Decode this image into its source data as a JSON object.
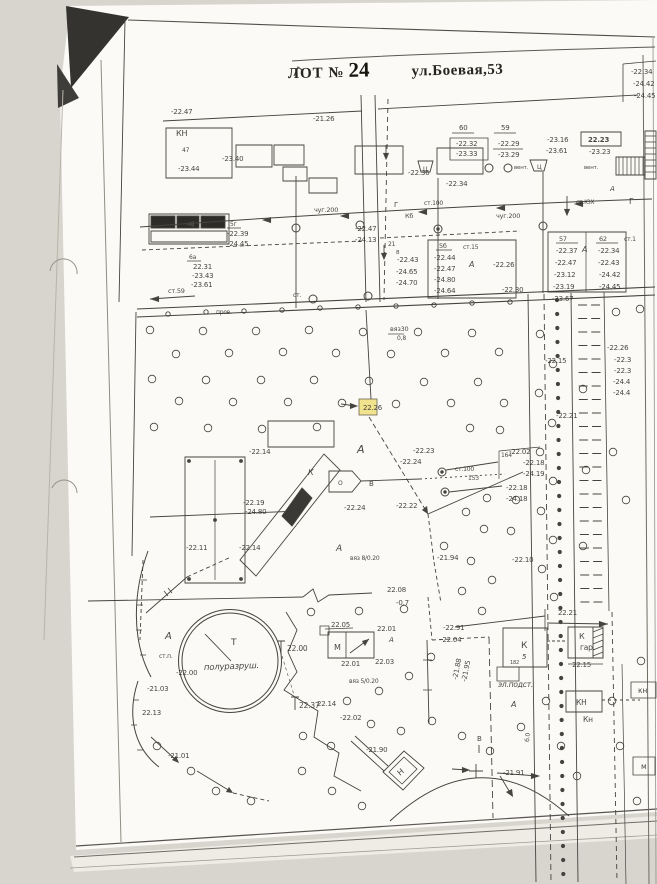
{
  "document": {
    "title_prefix": "ЛОТ №",
    "lot_number": "24",
    "address": "ул.Боевая,53"
  },
  "map": {
    "highlight": {
      "color": "#f1e28e",
      "label": "22.26"
    },
    "annotations": [
      {
        "t": "-22.47",
        "x": 171,
        "y": 114
      },
      {
        "t": "-21.26",
        "x": 313,
        "y": 121
      },
      {
        "t": "КН",
        "x": 176,
        "y": 136,
        "s": 8
      },
      {
        "t": "47",
        "x": 182,
        "y": 152,
        "s": 6
      },
      {
        "t": "-23.44",
        "x": 178,
        "y": 171
      },
      {
        "t": "-23.40",
        "x": 222,
        "y": 161
      },
      {
        "t": "60",
        "x": 459,
        "y": 130
      },
      {
        "t": "59",
        "x": 501,
        "y": 130
      },
      {
        "t": "-22.32",
        "x": 456,
        "y": 146
      },
      {
        "t": "-23.33",
        "x": 456,
        "y": 156
      },
      {
        "t": "-22.29",
        "x": 498,
        "y": 146
      },
      {
        "t": "-23.29",
        "x": 498,
        "y": 157
      },
      {
        "t": "-23.16",
        "x": 547,
        "y": 142
      },
      {
        "t": "-23.61",
        "x": 546,
        "y": 153
      },
      {
        "t": "22.23",
        "x": 588,
        "y": 142,
        "b": 1
      },
      {
        "t": "-23.23",
        "x": 589,
        "y": 154
      },
      {
        "t": "-22.34",
        "x": 631,
        "y": 74
      },
      {
        "t": "-24.42",
        "x": 633,
        "y": 86
      },
      {
        "t": "-24.45",
        "x": 634,
        "y": 98
      },
      {
        "t": "Ц",
        "x": 423,
        "y": 171,
        "s": 6
      },
      {
        "t": "вент.",
        "x": 514,
        "y": 169,
        "s": 5.5
      },
      {
        "t": "Ц",
        "x": 537,
        "y": 169,
        "s": 6
      },
      {
        "t": "вент.",
        "x": 584,
        "y": 169,
        "s": 5.5
      },
      {
        "t": "-22.36",
        "x": 408,
        "y": 175
      },
      {
        "t": "-22.34",
        "x": 446,
        "y": 186
      },
      {
        "t": "чуг.200",
        "x": 314,
        "y": 212,
        "s": 6.5
      },
      {
        "t": "чуг.200",
        "x": 496,
        "y": 218,
        "s": 6.5
      },
      {
        "t": "Кб",
        "x": 405,
        "y": 218,
        "s": 6.5
      },
      {
        "t": "Г",
        "x": 394,
        "y": 207
      },
      {
        "t": "ст.100",
        "x": 424,
        "y": 205,
        "s": 6
      },
      {
        "t": "ст.ЮХ",
        "x": 576,
        "y": 204,
        "s": 6
      },
      {
        "t": "Г",
        "x": 629,
        "y": 204,
        "s": 8
      },
      {
        "t": "А",
        "x": 610,
        "y": 191,
        "i": 1
      },
      {
        "t": "6а",
        "x": 189,
        "y": 259,
        "s": 6
      },
      {
        "t": "22.31",
        "x": 193,
        "y": 269
      },
      {
        "t": "-23.43",
        "x": 192,
        "y": 278
      },
      {
        "t": "-23.61",
        "x": 191,
        "y": 287
      },
      {
        "t": "5г",
        "x": 230,
        "y": 226,
        "s": 6
      },
      {
        "t": "-22.39",
        "x": 227,
        "y": 236
      },
      {
        "t": "-24.45",
        "x": 227,
        "y": 246
      },
      {
        "t": "-22.47",
        "x": 355,
        "y": 231
      },
      {
        "t": "-24.13",
        "x": 355,
        "y": 242
      },
      {
        "t": "21",
        "x": 388,
        "y": 246,
        "s": 6
      },
      {
        "t": "8",
        "x": 396,
        "y": 254,
        "s": 5.5
      },
      {
        "t": "-22.43",
        "x": 397,
        "y": 262
      },
      {
        "t": "-24.65",
        "x": 396,
        "y": 274
      },
      {
        "t": "-24.70",
        "x": 396,
        "y": 285
      },
      {
        "t": "5б",
        "x": 439,
        "y": 248,
        "s": 6.5
      },
      {
        "t": "ст.15",
        "x": 463,
        "y": 249,
        "s": 6
      },
      {
        "t": "-22.44",
        "x": 434,
        "y": 260
      },
      {
        "t": "-22.47",
        "x": 434,
        "y": 271
      },
      {
        "t": "-24.80",
        "x": 434,
        "y": 282
      },
      {
        "t": "-24.64",
        "x": 434,
        "y": 293
      },
      {
        "t": "А",
        "x": 469,
        "y": 267,
        "i": 1,
        "s": 8
      },
      {
        "t": "-22.26",
        "x": 493,
        "y": 267
      },
      {
        "t": "-22.30",
        "x": 502,
        "y": 292
      },
      {
        "t": "57",
        "x": 559,
        "y": 241,
        "s": 6.5
      },
      {
        "t": "-22.37",
        "x": 556,
        "y": 253
      },
      {
        "t": "-22.47",
        "x": 555,
        "y": 265
      },
      {
        "t": "-23.12",
        "x": 554,
        "y": 277
      },
      {
        "t": "-23.19",
        "x": 553,
        "y": 289
      },
      {
        "t": "-23.67",
        "x": 552,
        "y": 301
      },
      {
        "t": "А",
        "x": 582,
        "y": 252,
        "i": 1,
        "s": 8
      },
      {
        "t": "62",
        "x": 599,
        "y": 241,
        "s": 6.5
      },
      {
        "t": "ст.1",
        "x": 624,
        "y": 241,
        "s": 6
      },
      {
        "t": "-22.34",
        "x": 598,
        "y": 253
      },
      {
        "t": "-22.43",
        "x": 598,
        "y": 265
      },
      {
        "t": "-24.42",
        "x": 599,
        "y": 277
      },
      {
        "t": "-24.45",
        "x": 599,
        "y": 289
      },
      {
        "t": "ст.59",
        "x": 168,
        "y": 293,
        "s": 6.5
      },
      {
        "t": "пров.",
        "x": 216,
        "y": 314,
        "s": 6
      },
      {
        "t": "ст.",
        "x": 293,
        "y": 297,
        "s": 6
      },
      {
        "t": "вяз30",
        "x": 390,
        "y": 331,
        "s": 6.5
      },
      {
        "t": "0,8",
        "x": 397,
        "y": 340,
        "s": 6
      },
      {
        "t": "-22.15",
        "x": 545,
        "y": 363
      },
      {
        "t": "-22.26",
        "x": 607,
        "y": 350
      },
      {
        "t": "-22.3",
        "x": 614,
        "y": 362
      },
      {
        "t": "-22.3",
        "x": 614,
        "y": 373
      },
      {
        "t": "-24.4",
        "x": 613,
        "y": 384
      },
      {
        "t": "-24.4",
        "x": 613,
        "y": 395
      },
      {
        "t": "-22.21",
        "x": 556,
        "y": 418
      },
      {
        "t": "22.26",
        "x": 363,
        "y": 410,
        "n": "highlighted-elevation-label"
      },
      {
        "t": "А",
        "x": 357,
        "y": 453,
        "i": 1,
        "s": 11
      },
      {
        "t": "-22.23",
        "x": 413,
        "y": 453
      },
      {
        "t": "-22.24",
        "x": 400,
        "y": 464
      },
      {
        "t": "ст.100",
        "x": 455,
        "y": 471,
        "s": 6
      },
      {
        "t": "153",
        "x": 468,
        "y": 480,
        "s": 6
      },
      {
        "t": "164",
        "x": 501,
        "y": 457,
        "s": 6
      },
      {
        "t": "-22.18",
        "x": 523,
        "y": 465
      },
      {
        "t": "-24.19",
        "x": 523,
        "y": 476
      },
      {
        "t": "-22.18",
        "x": 506,
        "y": 490
      },
      {
        "t": "-24.18",
        "x": 506,
        "y": 501
      },
      {
        "t": "В",
        "x": 369,
        "y": 486
      },
      {
        "t": "О",
        "x": 338,
        "y": 485,
        "s": 6
      },
      {
        "t": "-22.22",
        "x": 396,
        "y": 508
      },
      {
        "t": "-22.02",
        "x": 509,
        "y": 454
      },
      {
        "t": "К",
        "x": 308,
        "y": 475,
        "i": 1,
        "s": 8
      },
      {
        "t": "-22.14",
        "x": 249,
        "y": 454
      },
      {
        "t": "-22.19",
        "x": 243,
        "y": 505
      },
      {
        "t": "-24.80",
        "x": 245,
        "y": 514
      },
      {
        "t": "-22.24",
        "x": 344,
        "y": 510
      },
      {
        "t": "-22.11",
        "x": 186,
        "y": 550
      },
      {
        "t": "-22.14",
        "x": 239,
        "y": 550
      },
      {
        "t": "А",
        "x": 336,
        "y": 551,
        "i": 1,
        "s": 9
      },
      {
        "t": "вяз 8/0.20",
        "x": 350,
        "y": 560,
        "s": 6
      },
      {
        "t": "-21.94",
        "x": 437,
        "y": 560
      },
      {
        "t": "-22.10",
        "x": 512,
        "y": 562
      },
      {
        "t": "22.08",
        "x": 387,
        "y": 592
      },
      {
        "t": "-0.7",
        "x": 396,
        "y": 605
      },
      {
        "t": "22.05",
        "x": 331,
        "y": 627
      },
      {
        "t": "22.01",
        "x": 377,
        "y": 631
      },
      {
        "t": "А",
        "x": 389,
        "y": 642,
        "i": 1,
        "s": 7
      },
      {
        "t": "-22.91",
        "x": 443,
        "y": 630
      },
      {
        "t": "-22.04",
        "x": 440,
        "y": 642
      },
      {
        "t": "М",
        "x": 334,
        "y": 650,
        "s": 8
      },
      {
        "t": "22.01",
        "x": 341,
        "y": 666
      },
      {
        "t": "22.03",
        "x": 375,
        "y": 664
      },
      {
        "t": "-21.88",
        "x": 457,
        "y": 680,
        "r": -78
      },
      {
        "t": "-21.95",
        "x": 466,
        "y": 682,
        "r": -78
      },
      {
        "t": "вяз 5/0.20",
        "x": 349,
        "y": 683,
        "s": 6
      },
      {
        "t": "22.14",
        "x": 317,
        "y": 706
      },
      {
        "t": "-22.02",
        "x": 340,
        "y": 720
      },
      {
        "t": "-21.90",
        "x": 366,
        "y": 752
      },
      {
        "t": "-21.91",
        "x": 503,
        "y": 775
      },
      {
        "t": "В",
        "x": 477,
        "y": 741
      },
      {
        "t": "Н",
        "x": 400,
        "y": 776,
        "s": 8,
        "r": -40
      },
      {
        "t": "22.21",
        "x": 558,
        "y": 615
      },
      {
        "t": "К",
        "x": 521,
        "y": 648,
        "s": 9
      },
      {
        "t": "5",
        "x": 522,
        "y": 659,
        "i": 1,
        "s": 7
      },
      {
        "t": "182",
        "x": 510,
        "y": 664,
        "s": 5
      },
      {
        "t": "эл.подст.",
        "x": 498,
        "y": 687,
        "i": 1,
        "s": 7.5
      },
      {
        "t": "А",
        "x": 511,
        "y": 707,
        "i": 1,
        "s": 8
      },
      {
        "t": "К",
        "x": 579,
        "y": 639,
        "s": 8
      },
      {
        "t": "гар.",
        "x": 580,
        "y": 650,
        "s": 7.5
      },
      {
        "t": "22.15",
        "x": 572,
        "y": 667,
        "s": 7
      },
      {
        "t": "КН",
        "x": 576,
        "y": 705,
        "s": 7.5
      },
      {
        "t": "Кн",
        "x": 583,
        "y": 722,
        "s": 7.5
      },
      {
        "t": "кн",
        "x": 638,
        "y": 693,
        "s": 7.5
      },
      {
        "t": "м",
        "x": 641,
        "y": 769,
        "s": 7.5
      },
      {
        "t": "б.0",
        "x": 529,
        "y": 742,
        "s": 6,
        "r": -85
      },
      {
        "t": "Т",
        "x": 231,
        "y": 645,
        "s": 9
      },
      {
        "t": "полуразруш.",
        "x": 204,
        "y": 670,
        "i": 1,
        "s": 8.5,
        "r": -2
      },
      {
        "t": "-22.00",
        "x": 176,
        "y": 675
      },
      {
        "t": "22.00",
        "x": 287,
        "y": 651,
        "s": 7.5
      },
      {
        "t": "22.37",
        "x": 299,
        "y": 708,
        "s": 7.5
      },
      {
        "t": "-21.03",
        "x": 147,
        "y": 691
      },
      {
        "t": "22.13",
        "x": 142,
        "y": 715
      },
      {
        "t": "А",
        "x": 165,
        "y": 639,
        "i": 1,
        "s": 10
      },
      {
        "t": "-21.01",
        "x": 168,
        "y": 758
      },
      {
        "t": "ст.п.",
        "x": 159,
        "y": 658,
        "s": 6
      }
    ]
  }
}
